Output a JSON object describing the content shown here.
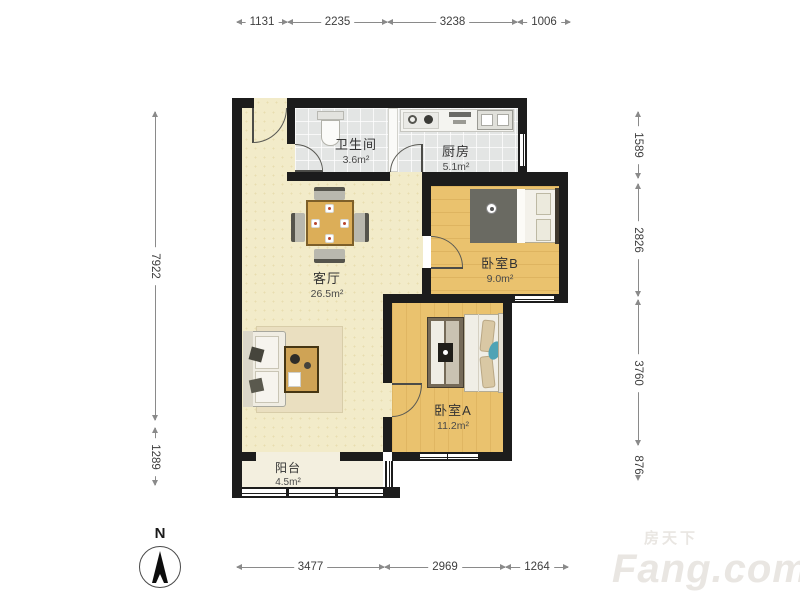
{
  "compass": {
    "label": "N"
  },
  "watermark": {
    "brand_cn": "房天下",
    "brand_en": "Fang.com"
  },
  "dims": {
    "top": [
      "1131",
      "2235",
      "3238",
      "1006"
    ],
    "bottom": [
      "3477",
      "2969",
      "1264"
    ],
    "left": [
      "7922",
      "1289"
    ],
    "right": [
      "1589",
      "2826",
      "3760",
      "876"
    ]
  },
  "rooms": {
    "bathroom": {
      "name": "卫生间",
      "area": "3.6m²"
    },
    "kitchen": {
      "name": "厨房",
      "area": "5.1m²"
    },
    "living": {
      "name": "客厅",
      "area": "26.5m²"
    },
    "bedroom_b": {
      "name": "卧室B",
      "area": "9.0m²"
    },
    "bedroom_a": {
      "name": "卧室A",
      "area": "11.2m²"
    },
    "balcony": {
      "name": "阳台",
      "area": "4.5m²"
    }
  },
  "colors": {
    "wall": "#1c1c1c",
    "living_floor": "#f2ebc9",
    "tile_floor": "#e3e5e4",
    "wood_floor": "#eac26e",
    "balcony_floor": "#f3efdf",
    "table_accent": "#dcae58",
    "duvet_dark": "#6a6a62",
    "pillow_tan": "#d9c8a4",
    "accent_blue": "#4fa3b5",
    "dimension_line": "#8a8a8a",
    "watermark": "#e9e6e2"
  }
}
